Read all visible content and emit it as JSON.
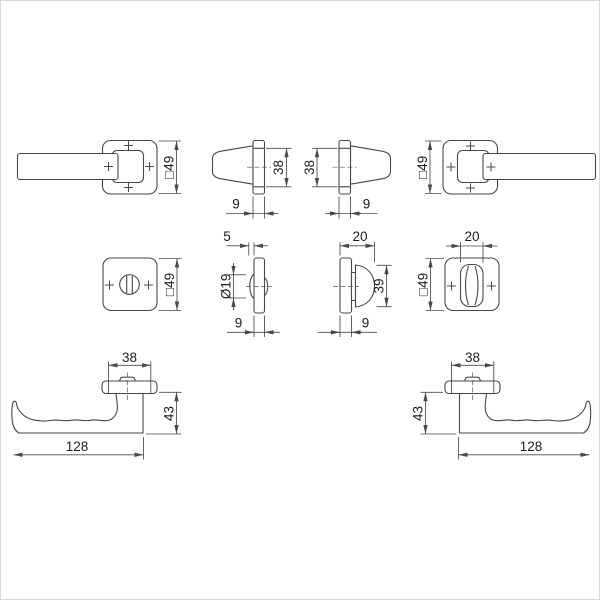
{
  "title": "door-handle-set-technical-drawing",
  "colors": {
    "line": "#474747",
    "text": "#1c1c1c",
    "background": "#ffffff",
    "frame": "#d9d9d9"
  },
  "rows": {
    "top": {
      "front_left": {
        "square_dim": "□49"
      },
      "side_left": {
        "height": "38",
        "thickness": "9"
      },
      "side_right": {
        "height": "38",
        "thickness": "9"
      },
      "front_right": {
        "square_dim": "□49"
      }
    },
    "middle": {
      "rose_emergency": {
        "square_dim": "□49"
      },
      "profile_emergency": {
        "disc_thickness": "5",
        "disc_diameter": "Ø19",
        "rose_thickness": "9"
      },
      "profile_thumbturn": {
        "turn_width": "20",
        "turn_height": "39",
        "rose_thickness": "9"
      },
      "rose_thumbturn": {
        "turn_width": "20",
        "square_dim": "□49"
      }
    },
    "bottom": {
      "lever_left": {
        "rose_width": "38",
        "height": "43",
        "length": "128"
      },
      "lever_right": {
        "rose_width": "38",
        "height": "43",
        "length": "128"
      }
    }
  }
}
